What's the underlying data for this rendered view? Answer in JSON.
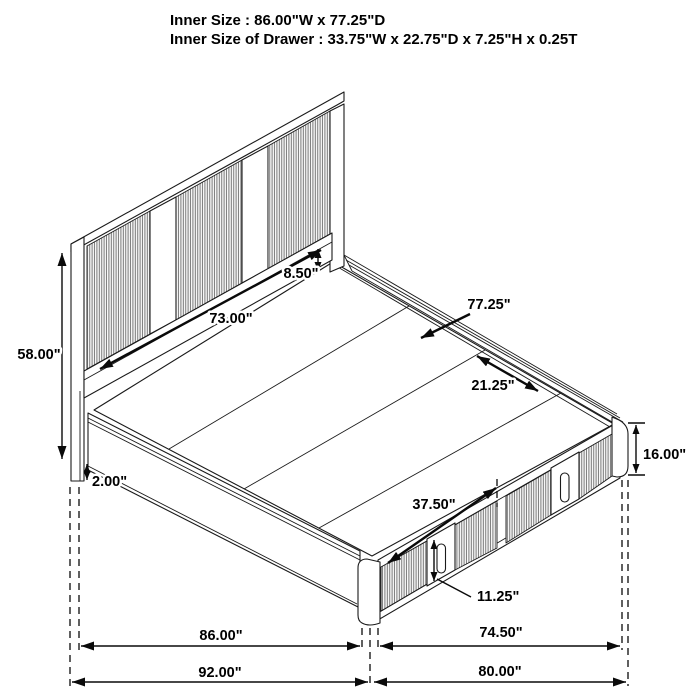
{
  "header": {
    "line1": "Inner Size : 86.00\"W x 77.25\"D",
    "line2": "Inner Size of Drawer : 33.75\"W x 22.75\"D x 7.25\"H x 0.25T"
  },
  "dimensions": {
    "headboard_height": "58.00\"",
    "headboard_panel_width": "73.00\"",
    "headboard_rail_height": "8.50\"",
    "inner_depth": "77.25\"",
    "slat_width": "21.25\"",
    "drawer_span": "37.50\"",
    "drawer_front_height": "11.25\"",
    "footboard_height": "16.00\"",
    "rail_floor_clearance": "2.00\"",
    "inner_width": "86.00\"",
    "foot_section_depth": "74.50\"",
    "outer_width": "92.00\"",
    "outer_depth": "80.00\""
  },
  "colors": {
    "line": "#1a1a1a",
    "dimension_line": "#0a0a0a",
    "rib_stripe": "#757575",
    "background": "#ffffff"
  }
}
